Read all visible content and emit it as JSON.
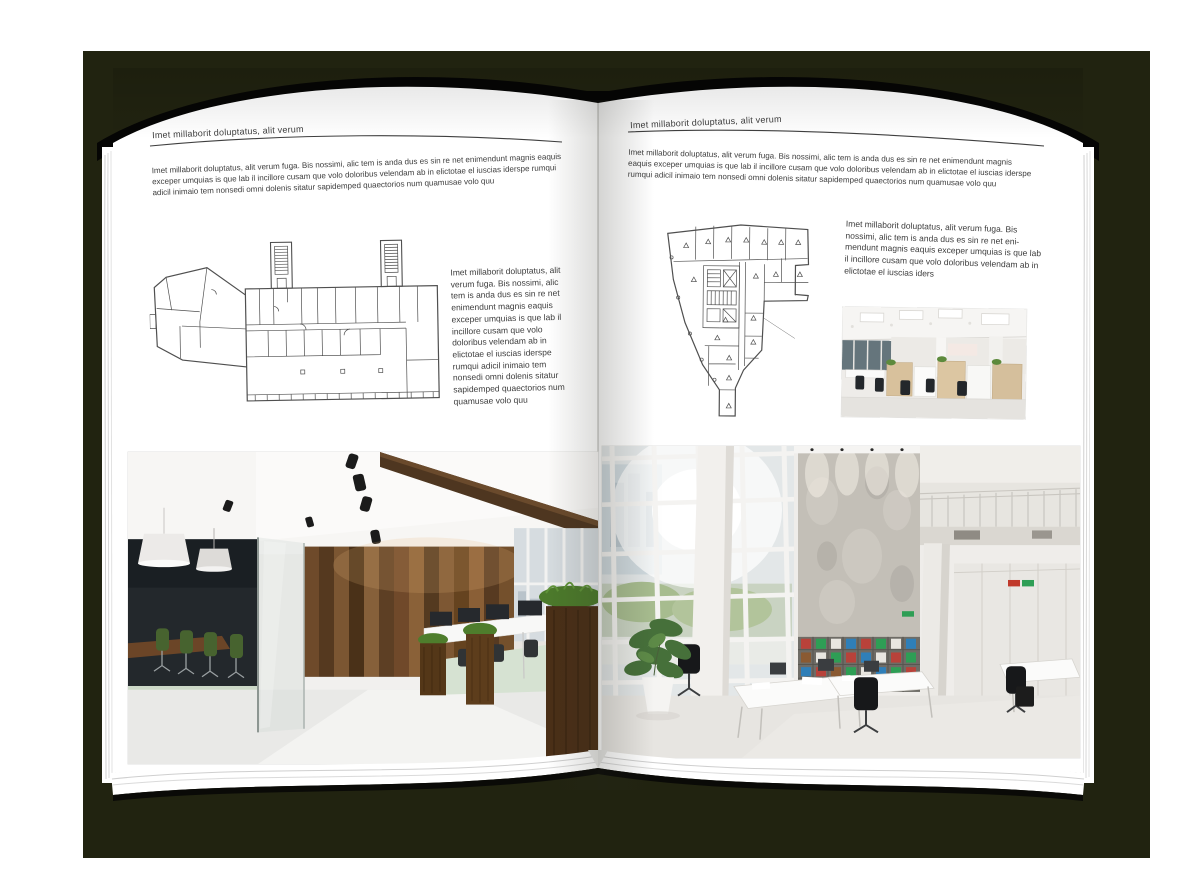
{
  "colors": {
    "backdrop": "#212310",
    "page": "#ffffff",
    "text": "#3c3c3c",
    "header_rule": "#3f3f3f",
    "floor_plan_line": "#4f4f4f"
  },
  "left_page": {
    "header": "Imet millaborit doluptatus, alit verum",
    "intro": "Imet millaborit doluptatus, alit verum fuga. Bis nossimi, alic tem is anda dus es sin re net enimendunt magnis eaquis exceper umquias is que lab il incillore cusam que volo doloribus velendam ab in elictotae el iuscias iderspe rumqui adicil inimaio tem nonsedi omni dolenis sitatur sapidemped quaectorios num quamusae volo quu",
    "side_text": "Imet millaborit doluptatus, alit verum fuga. Bis nossimi, alic tem is anda dus es sin re net enimendunt magnis eaquis exceper umquias is que lab il incillore cusam que volo doloribus velendam ab in elictotae el iuscias iderspe rumqui adicil inimaio tem nonsedi omni dolenis sitatur sapidemped quaectorios num quamusae volo quu"
  },
  "right_page": {
    "header": "Imet millaborit doluptatus, alit verum",
    "intro": "Imet millaborit doluptatus, alit verum fuga. Bis nossimi, alic tem is anda dus es sin re net enimendunt magnis eaquis exceper umquias is que lab il incillore cusam que volo doloribus velendam ab in elictotae el iuscias iderspe rumqui adicil inimaio tem nonsedi omni dolenis sitatur sapidemped quaectorios num quamusae volo quu",
    "side_text": "Imet millaborit doluptatus, alit verum fuga. Bis nossimi, alic tem is anda dus es sin re net eni­mendunt magnis eaquis exceper umquias is que lab il incillore cusam que volo doloribus velendam ab in elictotae el iuscias iders"
  }
}
